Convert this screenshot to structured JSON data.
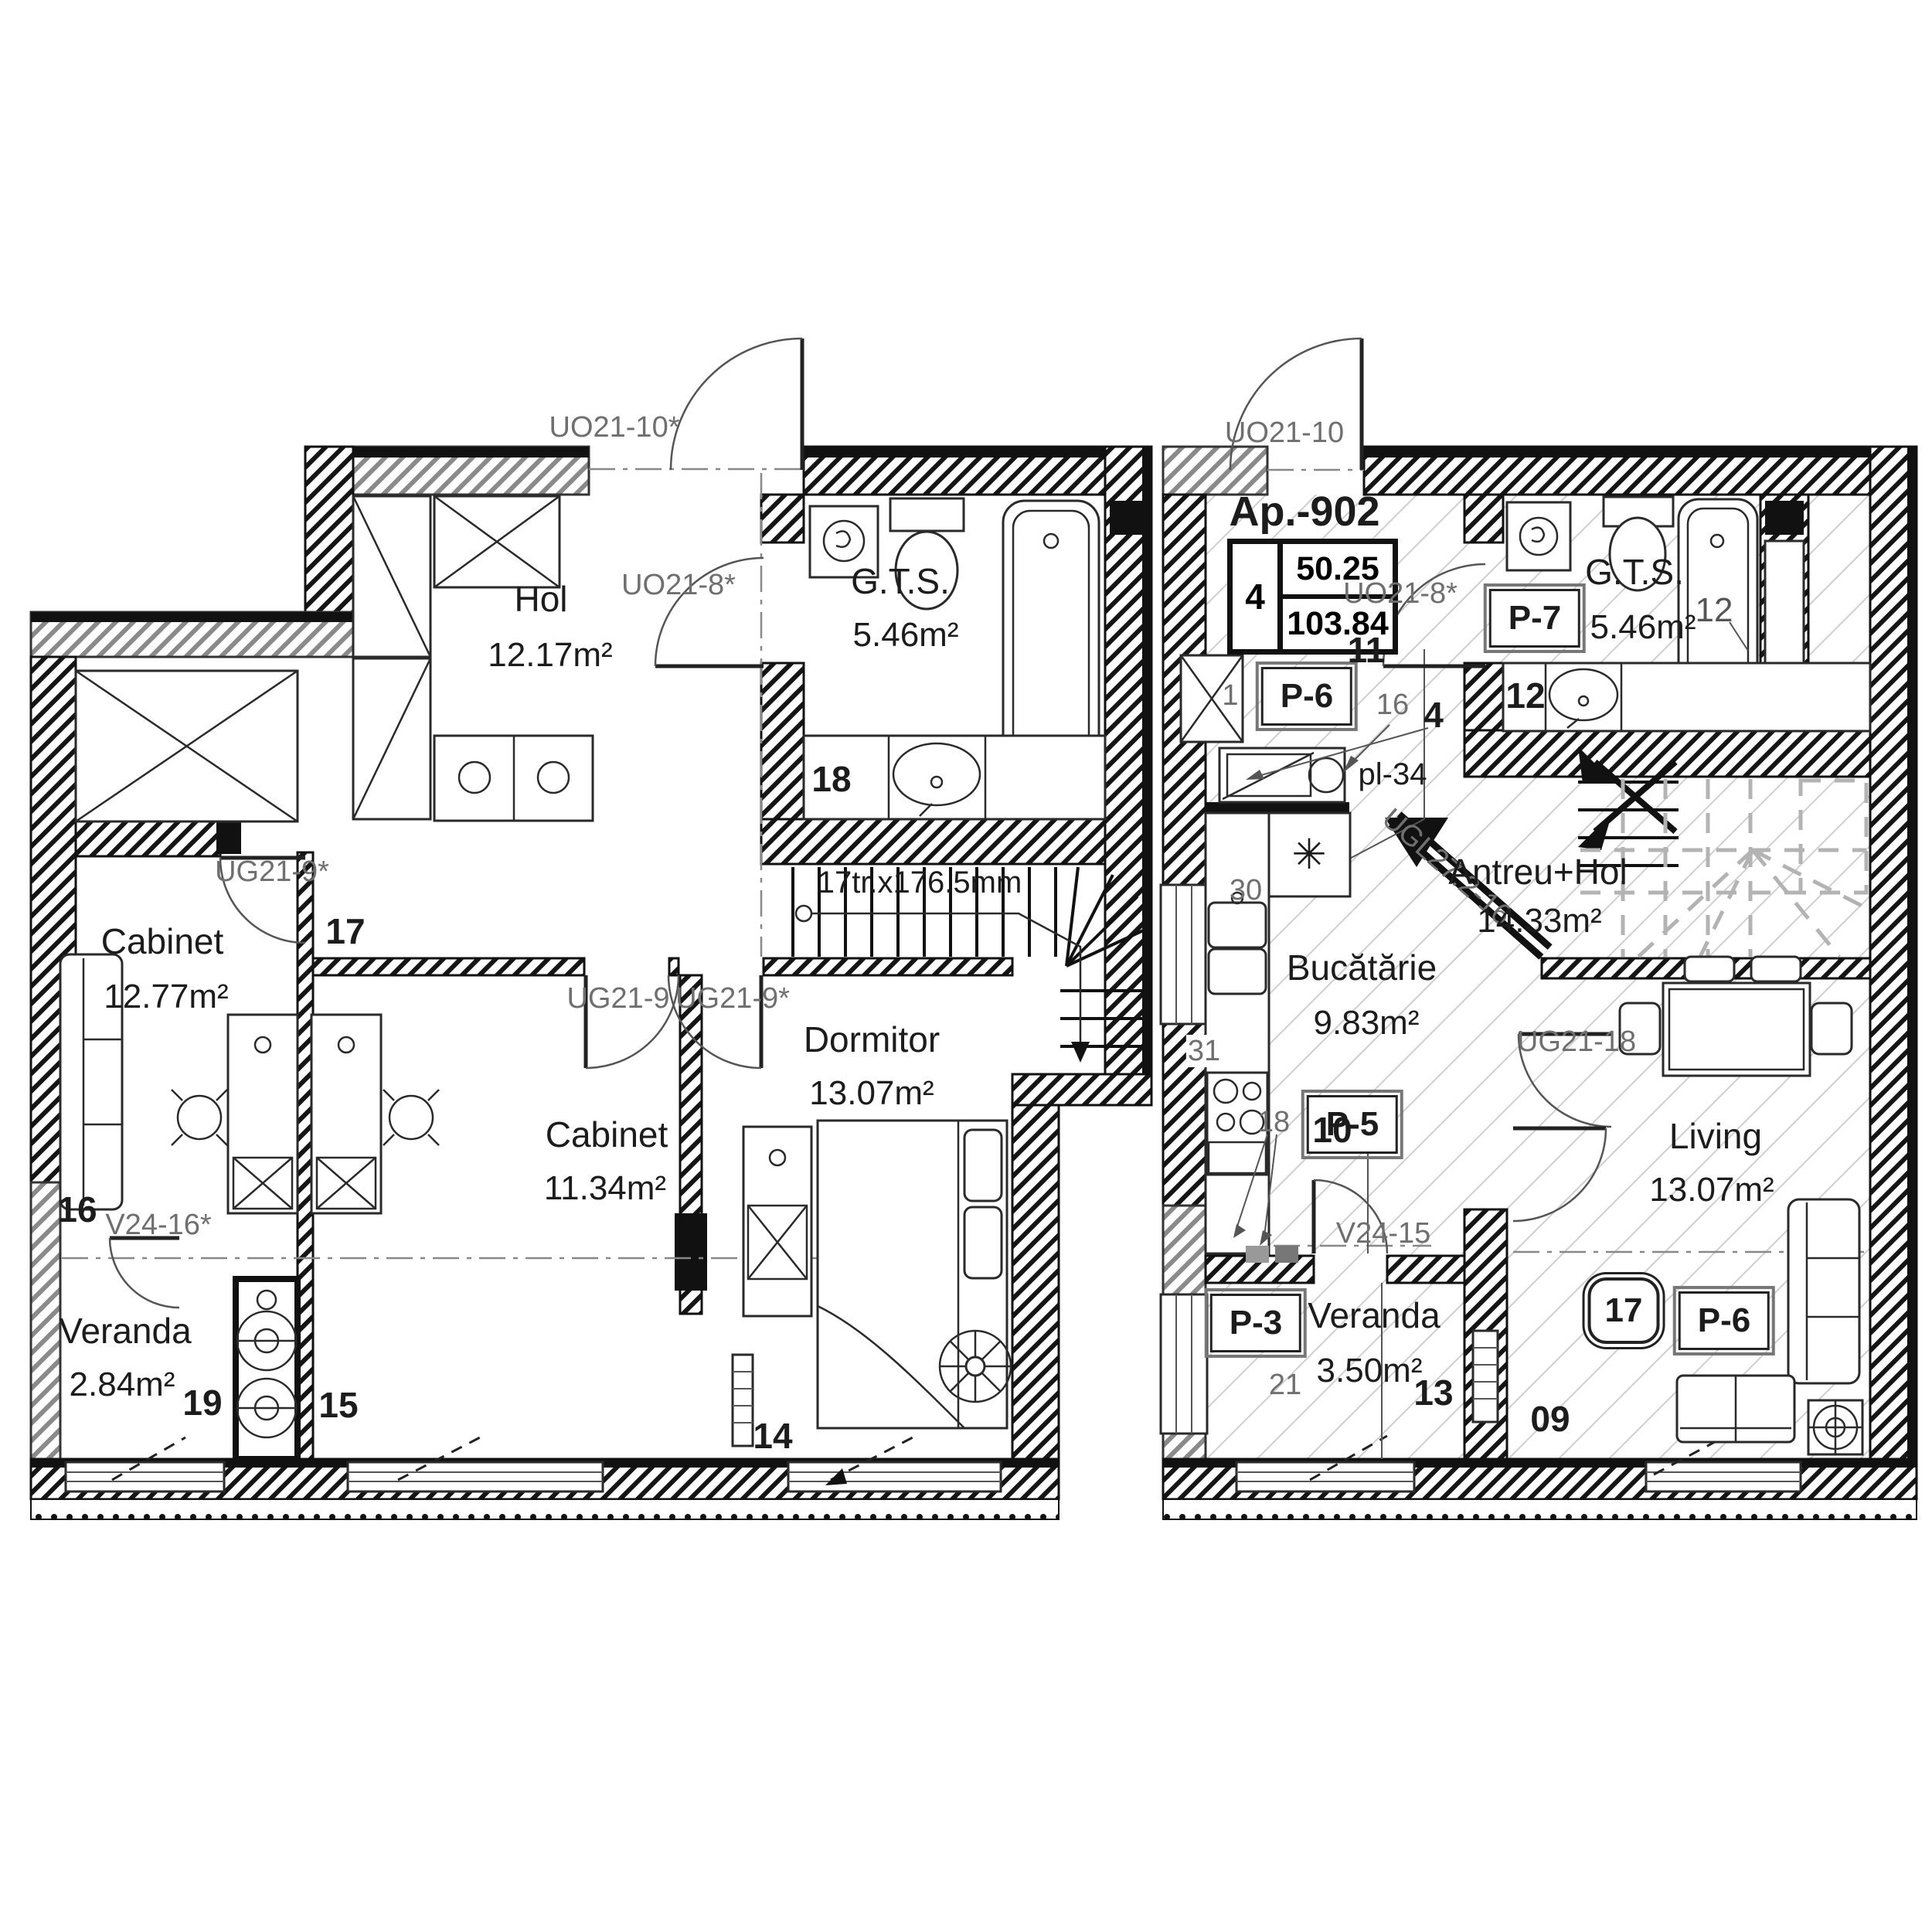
{
  "left_plan": {
    "rooms": {
      "hol": {
        "name": "Hol",
        "area": "12.17m²",
        "number": "17"
      },
      "gts": {
        "name": "G.T.S.",
        "area": "5.46m²",
        "number": "18"
      },
      "cabinet_1": {
        "name": "Cabinet",
        "area": "12.77m²",
        "number": "16"
      },
      "cabinet_2": {
        "name": "Cabinet",
        "area": "11.34m²",
        "number": "15"
      },
      "dormitor": {
        "name": "Dormitor",
        "area": "13.07m²",
        "number": "14"
      },
      "veranda": {
        "name": "Veranda",
        "area": "2.84m²",
        "number": "19"
      }
    },
    "stairs_label": "17tr.x176.5mm",
    "codes": {
      "entry_door": "UO21-10*",
      "gts_door": "UO21-8*",
      "cabinet_1_door": "UG21-9*",
      "cabinet_2_door": "UG21-9",
      "dormitor_door": "UG21-9*",
      "veranda_door": "V24-16*"
    }
  },
  "right_plan": {
    "apartment": {
      "id": "Ap.-902",
      "room_count": "4",
      "area_living": "50.25",
      "area_total": "103.84"
    },
    "rooms": {
      "gts": {
        "name": "G.T.S.",
        "area": "5.46m²",
        "number": "12"
      },
      "antreu": {
        "name": "Antreu+Hol",
        "area": "14.33m²",
        "number": "11"
      },
      "bucatarie": {
        "name": "Bucătărie",
        "area": "9.83m²",
        "number": "10"
      },
      "living": {
        "name": "Living",
        "area": "13.07m²",
        "number": "09"
      },
      "veranda": {
        "name": "Veranda",
        "area": "3.50m²",
        "number": "13"
      }
    },
    "codes": {
      "entry_door": "UO21-10",
      "gts_door": "UO21-8*",
      "living_door": "UG21-18",
      "veranda_door": "V24-15",
      "stair_wall": "UGL27.2-16",
      "landing": "pl-34"
    },
    "finish_tags": {
      "veranda": "P-3",
      "bucatarie": "P-5",
      "hol": "P-6",
      "living": "P-6",
      "gts": "P-7"
    },
    "ref_numbers": {
      "closet": "1",
      "n16": "16",
      "n4": "4",
      "n30": "30",
      "n31": "31",
      "n18": "18",
      "n21": "21",
      "tub": "12",
      "living_badge": "17"
    },
    "symbols": {
      "kitchen_hood": "✳"
    }
  }
}
